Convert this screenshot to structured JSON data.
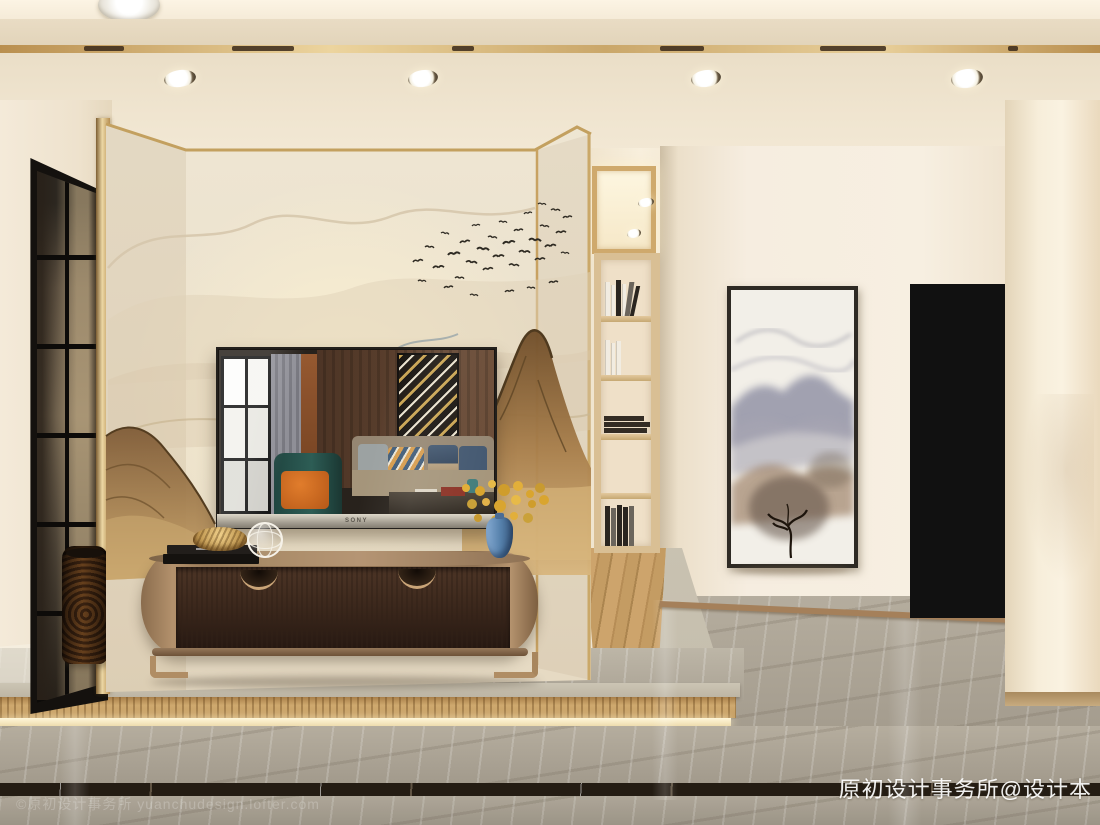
{
  "meta": {
    "title": "Modern Chinese style living room interior rendering"
  },
  "watermarks": {
    "bottom_right": "原初设计事务所@设计本",
    "bottom_left": "©原初设计事务所 yuanchudesign.lofter.com"
  },
  "tv": {
    "brand": "SONY"
  },
  "palette": {
    "ceiling_cream": "#ece1cc",
    "gold_trim": "#c7a263",
    "wall_cream": "#f2e9d8",
    "mural_brown": "#9c7344",
    "cabinet_wood_dark": "#3a281c",
    "cabinet_frame_bronze": "#8d7153",
    "floor_marble_grey": "#aba395",
    "floor_band_dark": "#241c13",
    "riser_tan": "#c09a63",
    "door_panel_taupe": "#9a9085",
    "door_frame_black": "#121212",
    "accent_orange": "#d2691e",
    "accent_teal": "#24514b",
    "flower_yellow": "#e0ac35",
    "vase_blue": "#5580ab",
    "hall_wood_floor": "#c49c66",
    "shelf_wood": "#d9bf94"
  },
  "scene": {
    "birds": [
      [
        413,
        262,
        1.0,
        -8
      ],
      [
        425,
        247,
        0.9,
        6
      ],
      [
        433,
        268,
        1.1,
        -4
      ],
      [
        441,
        233,
        0.8,
        10
      ],
      [
        448,
        255,
        1.2,
        -6
      ],
      [
        455,
        278,
        0.9,
        4
      ],
      [
        460,
        243,
        1.0,
        -10
      ],
      [
        466,
        262,
        1.1,
        8
      ],
      [
        472,
        226,
        0.8,
        -5
      ],
      [
        477,
        249,
        1.2,
        6
      ],
      [
        483,
        270,
        1.0,
        -7
      ],
      [
        488,
        237,
        0.9,
        9
      ],
      [
        493,
        257,
        1.1,
        -3
      ],
      [
        499,
        222,
        0.8,
        5
      ],
      [
        503,
        244,
        1.2,
        -9
      ],
      [
        509,
        265,
        1.0,
        7
      ],
      [
        514,
        231,
        0.9,
        -6
      ],
      [
        519,
        252,
        1.1,
        4
      ],
      [
        524,
        214,
        0.8,
        -8
      ],
      [
        529,
        240,
        1.2,
        6
      ],
      [
        535,
        260,
        1.0,
        -5
      ],
      [
        540,
        226,
        0.9,
        8
      ],
      [
        545,
        247,
        1.1,
        -7
      ],
      [
        551,
        210,
        0.9,
        5
      ],
      [
        556,
        233,
        1.0,
        -4
      ],
      [
        561,
        253,
        0.8,
        6
      ],
      [
        549,
        283,
        0.9,
        -6
      ],
      [
        527,
        288,
        0.8,
        4
      ],
      [
        505,
        292,
        0.9,
        -5
      ],
      [
        470,
        295,
        0.8,
        7
      ],
      [
        444,
        288,
        0.9,
        -6
      ],
      [
        418,
        281,
        0.8,
        5
      ],
      [
        563,
        218,
        0.9,
        -7
      ],
      [
        538,
        204,
        0.8,
        6
      ]
    ]
  }
}
